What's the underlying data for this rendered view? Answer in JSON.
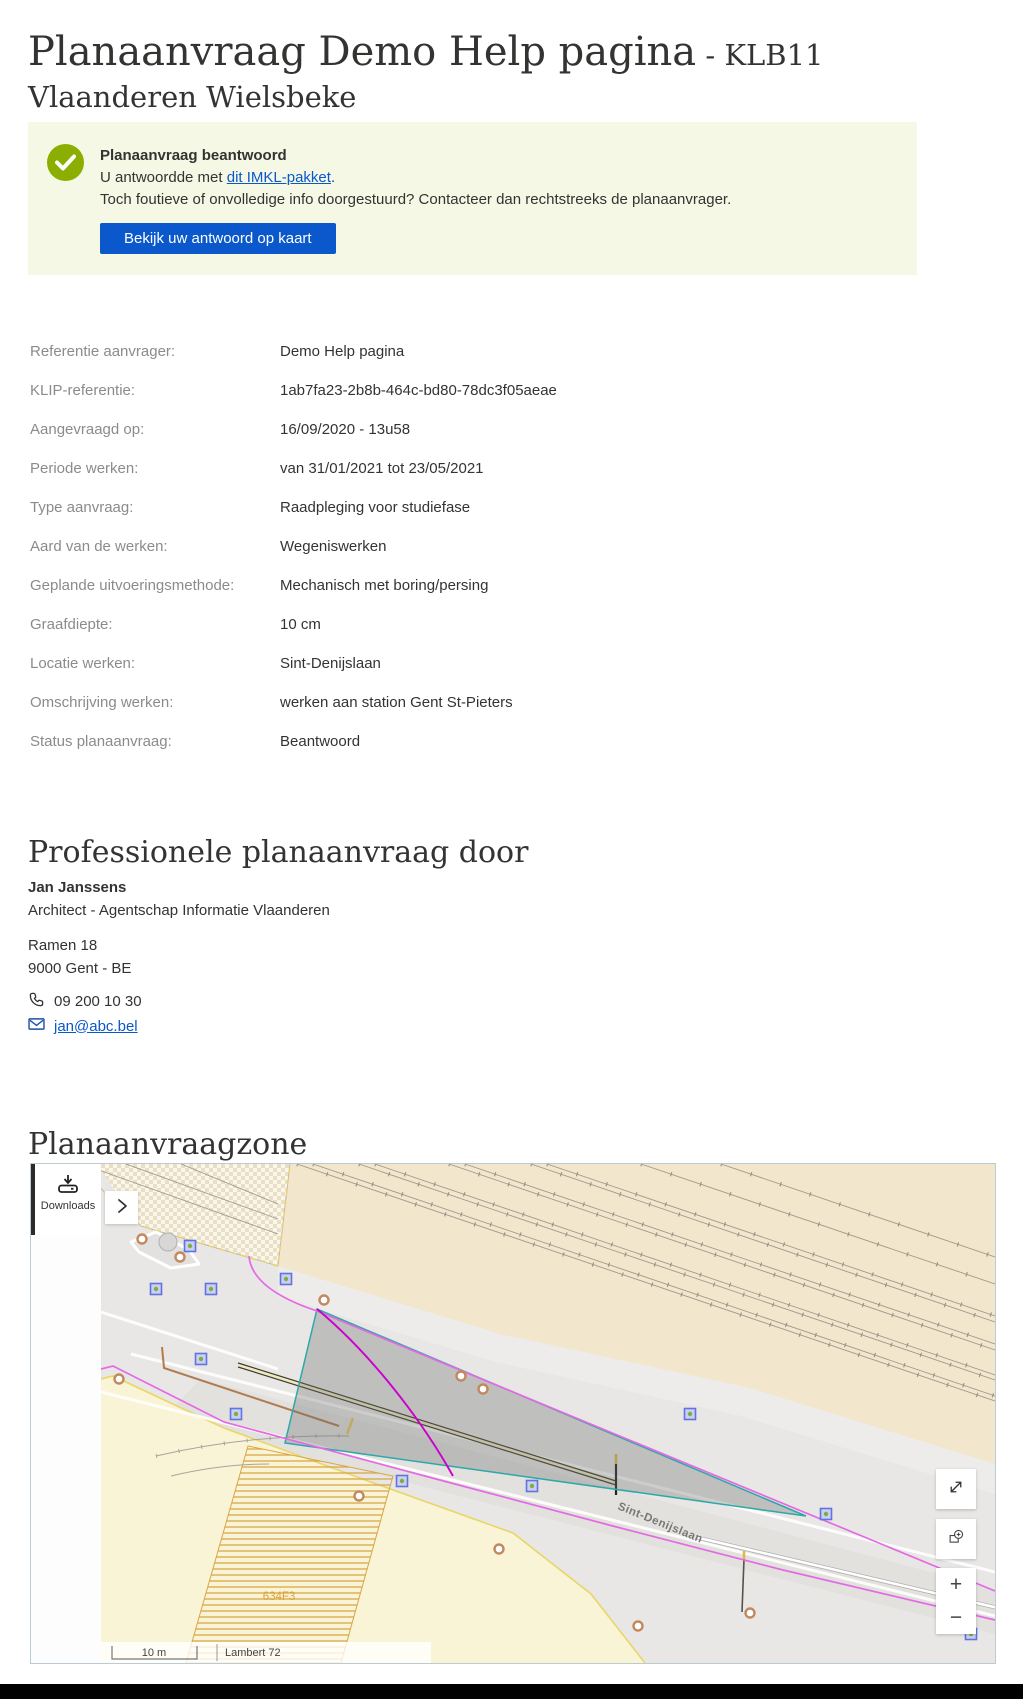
{
  "colors": {
    "blue": "#0a58cc",
    "green": "#8bae00",
    "banner_bg": "#f5f8e4"
  },
  "header": {
    "title_main": "Planaanvraag Demo Help pagina",
    "title_suffix": " - KLB11 Vlaanderen Wielsbeke"
  },
  "banner": {
    "title": "Planaanvraag beantwoord",
    "line1_prefix": "U antwoordde met ",
    "line1_link": "dit IMKL-pakket",
    "line1_suffix": ".",
    "line2": "Toch foutieve of onvolledige info doorgestuurd? Contacteer dan rechtstreeks de planaanvrager.",
    "button_label": "Bekijk uw antwoord op kaart",
    "icon": "checkmark-circle-icon"
  },
  "details": {
    "rows": [
      {
        "label": "Referentie aanvrager:",
        "value": "Demo Help pagina"
      },
      {
        "label": "KLIP-referentie:",
        "value": "1ab7fa23-2b8b-464c-bd80-78dc3f05aeae"
      },
      {
        "label": "Aangevraagd op:",
        "value": "16/09/2020 - 13u58"
      },
      {
        "label": "Periode werken:",
        "value": "van 31/01/2021 tot 23/05/2021"
      },
      {
        "label": "Type aanvraag:",
        "value": "Raadpleging voor studiefase"
      },
      {
        "label": "Aard van de werken:",
        "value": "Wegeniswerken"
      },
      {
        "label": "Geplande uitvoeringsmethode:",
        "value": "Mechanisch met boring/persing"
      },
      {
        "label": "Graafdiepte:",
        "value": "10 cm"
      },
      {
        "label": "Locatie werken:",
        "value": "Sint-Denijslaan"
      },
      {
        "label": "Omschrijving werken:",
        "value": "werken aan station Gent St-Pieters"
      },
      {
        "label": "Status planaanvraag:",
        "value": "Beantwoord"
      }
    ]
  },
  "requester": {
    "heading": "Professionele planaanvraag door",
    "name": "Jan Janssens",
    "role": "Architect - Agentschap Informatie Vlaanderen",
    "address_line1": "Ramen 18",
    "address_line2": "9000 Gent - BE",
    "phone": "09 200 10 30",
    "email": "jan@abc.bel",
    "icons": [
      "phone-icon",
      "envelope-icon"
    ]
  },
  "map_section": {
    "heading": "Planaanvraagzone",
    "downloads_label": "Downloads",
    "street_label": "Sint-Denijslaan",
    "parcel_label": "634F3",
    "scale_label": "10 m",
    "projection_label": "Lambert 72",
    "controls": {
      "zoom_in": "+",
      "zoom_out": "−",
      "icons": [
        "download-icon",
        "chevron-right-icon",
        "expand-icon",
        "zoom-extent-icon",
        "plus-icon",
        "minus-icon"
      ]
    }
  }
}
